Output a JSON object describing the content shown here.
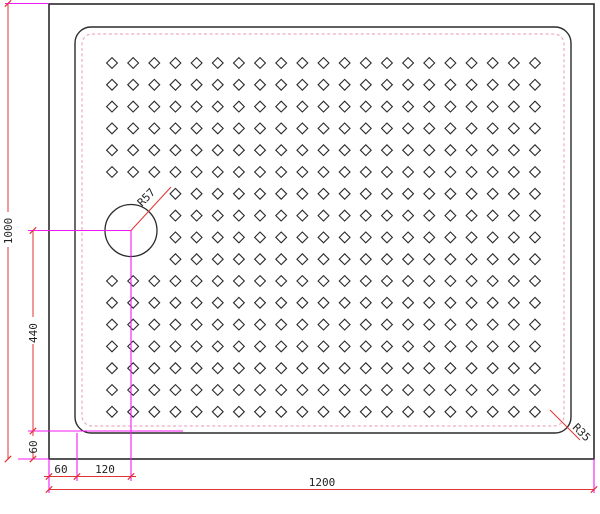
{
  "labels": {
    "overall_width": "1200",
    "overall_height": "1000",
    "drain_to_bottom": "440",
    "bottom_wall_thickness": "60",
    "left_wall_thickness": "60",
    "drain_offset_x": "120",
    "drain_radius": "R57",
    "corner_radius": "R35"
  },
  "colors": {
    "outline": "#2b2b2b",
    "dimension_line": "#e23333",
    "extension_line": "#f318f3",
    "inset_dashed": "#eeaac8",
    "text": "#1f1f1f",
    "background": "#ffffff"
  },
  "pattern": {
    "rows": 17,
    "cols": 21,
    "start_x": 112,
    "start_y": 63,
    "step_x": 21.15,
    "step_y": 21.8,
    "half_size": 5.4,
    "skip_cols": [
      0,
      1,
      2
    ],
    "skip_rows": [
      6,
      7,
      8,
      9
    ]
  }
}
